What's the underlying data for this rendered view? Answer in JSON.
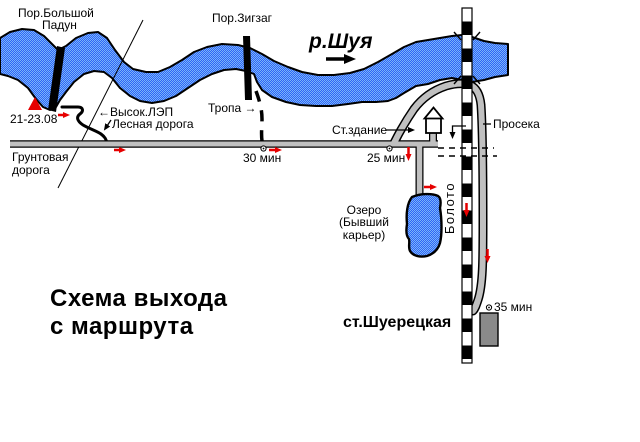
{
  "title": {
    "line1": "Схема выхода",
    "line2": "с маршрута"
  },
  "labels": {
    "rapid_big_line1": "Пор.Большой",
    "rapid_big_line2": "Падун",
    "rapid_zigzag": "Пор.Зигзаг",
    "river": "р.Шуя",
    "camp_dates": "21-23.08",
    "power_line": "←Высок.ЛЭП",
    "forest_road": "Лесная дорога",
    "trail": "Тропа →",
    "dirt_road_line1": "Грунтовая",
    "dirt_road_line2": "дорога",
    "time_30": "30 мин",
    "time_25": "25 мин",
    "time_35": "35 мин",
    "station_building": "Ст.здание",
    "clearing": "Просека",
    "swamp": "Болото",
    "lake_line1": "Озеро",
    "lake_line2": "(Бывший",
    "lake_line3": "карьер)",
    "station": "ст.Шуерецкая"
  },
  "colors": {
    "river_dark": "#2f63f7",
    "river_light": "#7ab6f9",
    "road_gray": "#c0c0c0",
    "platform_gray": "#8a8a8a",
    "route_red": "#e60000",
    "outline_black": "#000000"
  }
}
